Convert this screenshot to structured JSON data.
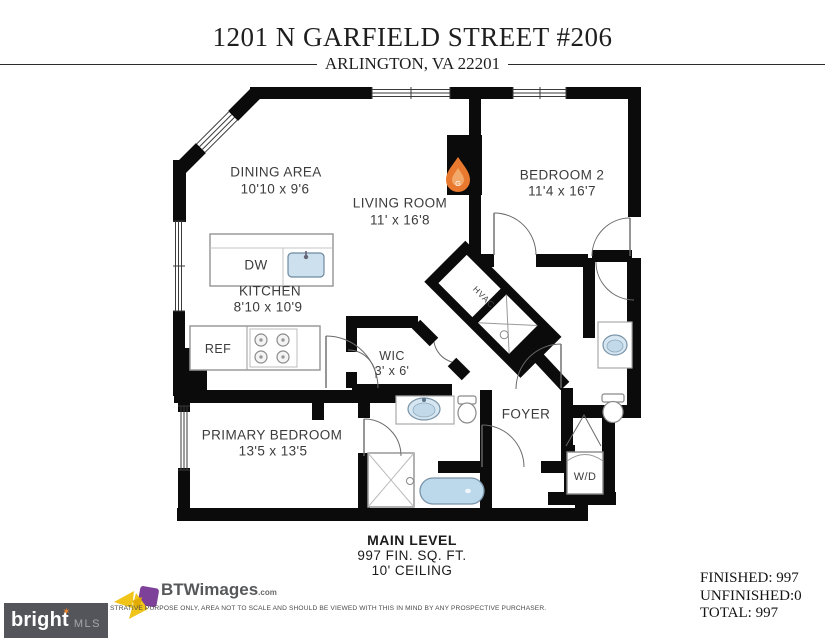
{
  "header": {
    "title": "1201 N GARFIELD STREET #206",
    "subtitle": "ARLINGTON, VA 22201"
  },
  "plan": {
    "rooms": [
      {
        "name": "DINING AREA",
        "dims": "10'10 x 9'6"
      },
      {
        "name": "LIVING ROOM",
        "dims": "11' x 16'8"
      },
      {
        "name": "BEDROOM 2",
        "dims": "11'4 x 16'7"
      },
      {
        "name": "KITCHEN",
        "dims": "8'10 x 10'9"
      },
      {
        "name": "WIC",
        "dims": "3' x 6'"
      },
      {
        "name": "PRIMARY BEDROOM",
        "dims": "13'5 x 13'5"
      },
      {
        "name": "FOYER",
        "dims": ""
      }
    ],
    "fixtures": {
      "dishwasher": "DW",
      "refrigerator": "REF",
      "washer_dryer": "W/D",
      "hvac": "HVAC",
      "fireplace_letter": "G"
    }
  },
  "level_summary": {
    "name": "MAIN LEVEL",
    "finished_area": "997 FIN. SQ. FT.",
    "ceiling": "10' CEILING"
  },
  "area_totals": {
    "finished": "FINISHED: 997",
    "unfinished": "UNFINISHED:0",
    "total": "TOTAL: 997"
  },
  "footer": {
    "photographer_brand": "BTWimages",
    "photographer_brand_suffix": ".com",
    "mls_logo_primary": "bright",
    "mls_logo_spark": "✶",
    "mls_logo_secondary": "MLS",
    "disclaimer": "STRATIVE PURPOSE ONLY, AREA NOT TO SCALE AND SHOULD BE VIEWED WITH THIS IN MIND BY ANY PROSPECTIVE PURCHASER."
  },
  "colors": {
    "wall": "#0b0b0b",
    "fireplace_accent": "#e8792e",
    "water_fixture": "#c9dff0",
    "mls_box": "#54555b",
    "brand_yellow": "#f0c419",
    "brand_purple": "#7d4199"
  }
}
